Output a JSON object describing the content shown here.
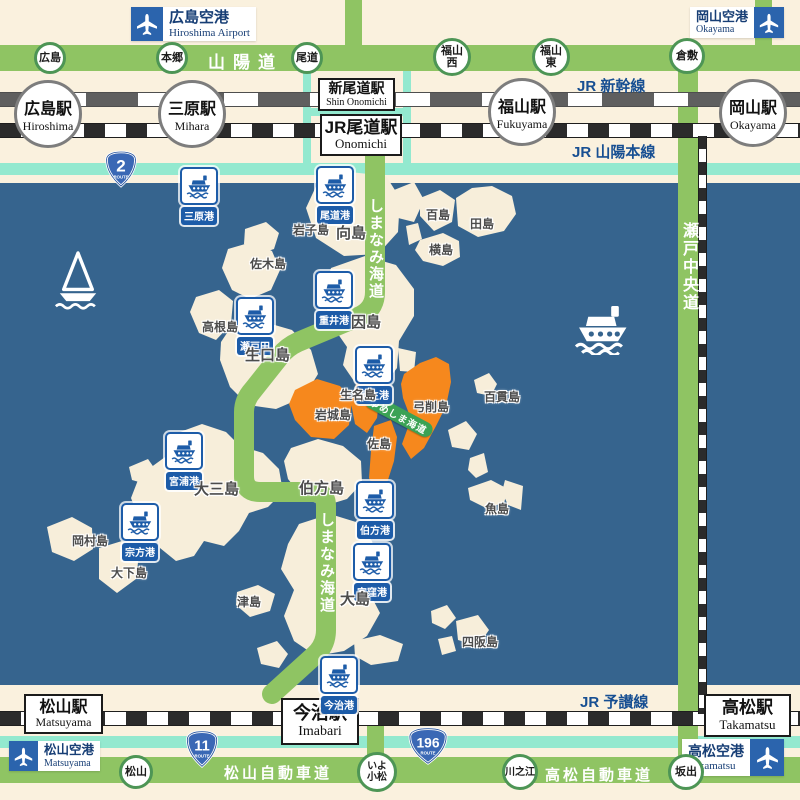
{
  "title": "しまなみ・ゆめしま海道 アクセスマップ",
  "airports": [
    {
      "jp": "広島空港",
      "en": "Hiroshima Airport"
    },
    {
      "jp": "岡山空港",
      "en": "Okayama"
    },
    {
      "jp": "松山空港",
      "en": "Matsuyama"
    },
    {
      "jp": "高松空港",
      "en": "Takamatsu"
    }
  ],
  "stations": {
    "circles": [
      {
        "jp": "広島駅",
        "en": "Hiroshima"
      },
      {
        "jp": "三原駅",
        "en": "Mihara"
      },
      {
        "jp": "福山駅",
        "en": "Fukuyama"
      },
      {
        "jp": "岡山駅",
        "en": "Okayama"
      }
    ],
    "boxes": [
      {
        "jp": "新尾道駅",
        "en": "Shin Onomichi"
      },
      {
        "jp": "JR尾道駅",
        "en": "Onomichi"
      },
      {
        "jp": "松山駅",
        "en": "Matsuyama"
      },
      {
        "jp": "今治駅",
        "en": "Imabari"
      },
      {
        "jp": "高松駅",
        "en": "Takamatsu"
      }
    ]
  },
  "rails": {
    "shinkansen": "JR 新幹線",
    "sanyo_main": "JR 山陽本線",
    "yosan": "JR 予讃線"
  },
  "roads": {
    "sanyo": "山陽道",
    "matsuyama": "松山自動車道",
    "takamatsu": "高松自動車道",
    "seto_chuo": "瀬戸中央道",
    "shimanami": "しまなみ海道",
    "yumeshima": "ゆめしま海道"
  },
  "ics": [
    "広島",
    "本郷",
    "尾道",
    "福山\n西",
    "福山\n東",
    "倉敷",
    "松山",
    "いよ\n小松",
    "川之江",
    "坂出"
  ],
  "shields": [
    {
      "num": "2",
      "sub": "ROUTE"
    },
    {
      "num": "11",
      "sub": "ROUTE"
    },
    {
      "num": "196",
      "sub": "ROUTE"
    }
  ],
  "ports": [
    "三原港",
    "尾道港",
    "重井港",
    "瀬戸田",
    "土生港",
    "宮浦港",
    "宗方港",
    "伯方港",
    "宮窪港",
    "今治港"
  ],
  "islands": [
    "向島",
    "岩子島",
    "百島",
    "田島",
    "横島",
    "佐木島",
    "高根島",
    "生口島",
    "因島",
    "百貫島",
    "生名島",
    "岩城島",
    "弓削島",
    "佐島",
    "魚島",
    "大三島",
    "伯方島",
    "岡村島",
    "大下島",
    "津島",
    "大島",
    "四阪島"
  ],
  "colors": {
    "sea": "#36648E",
    "land": "#F7EEDA",
    "road_green": "#8FC463",
    "teal": "#93E9CF",
    "highlight_orange": "#F6881D",
    "port_blue": "#1D5CA8",
    "rail_text_blue": "#174F92",
    "yumeshima_green": "#3BA255"
  }
}
